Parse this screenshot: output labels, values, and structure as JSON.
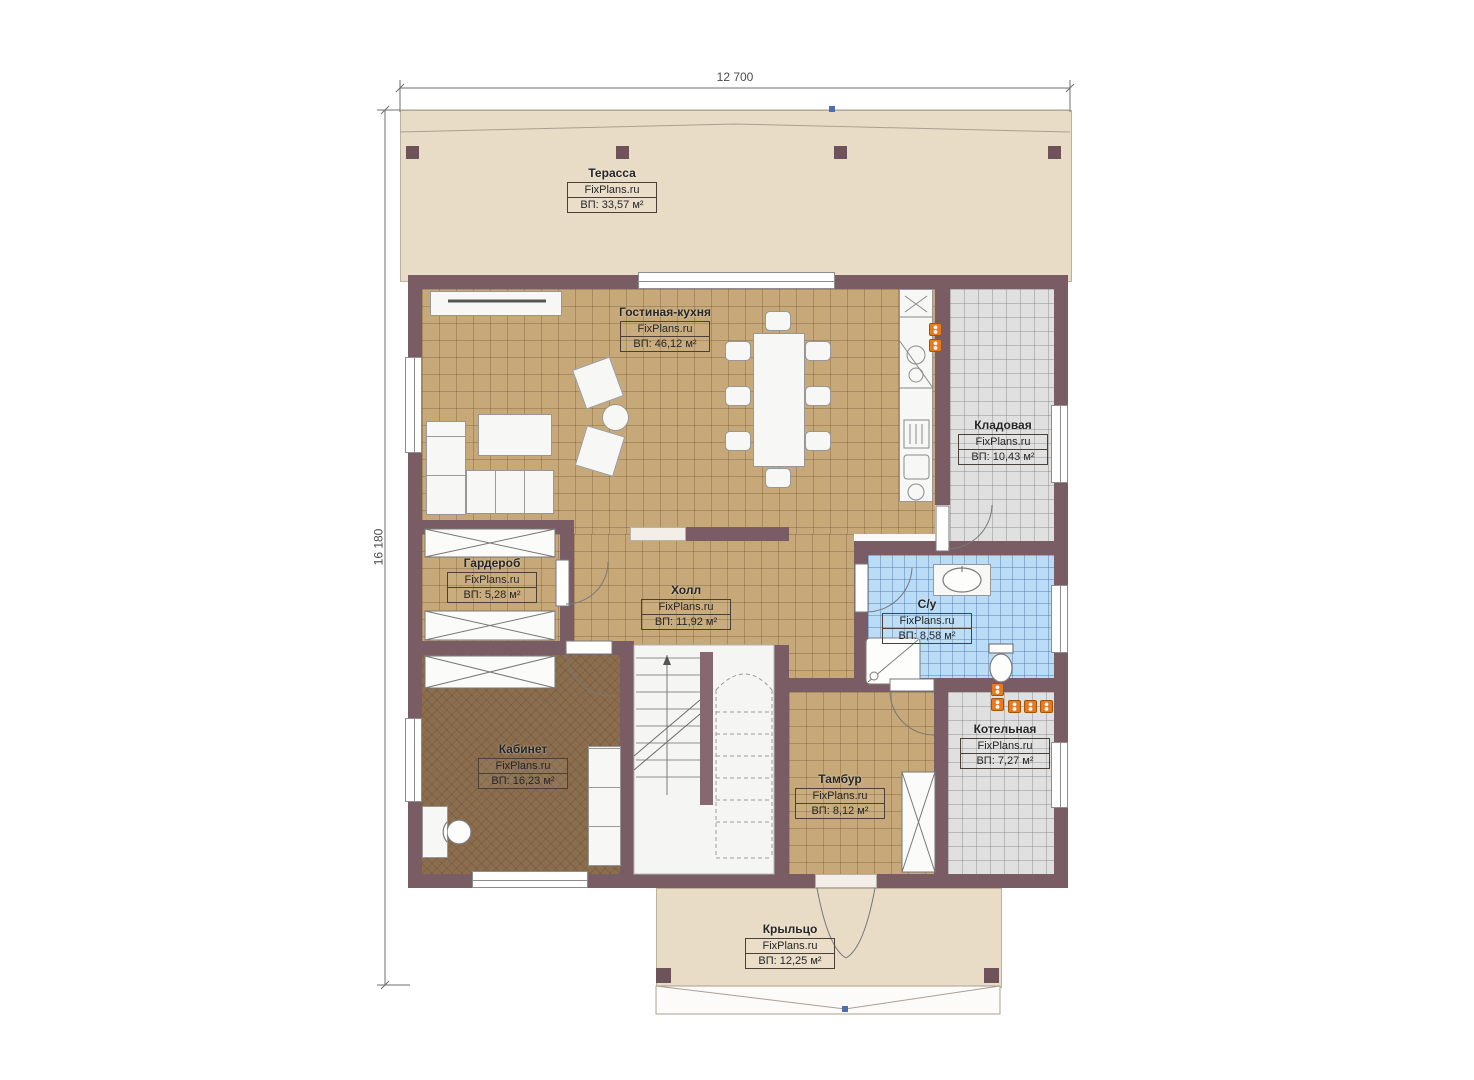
{
  "dimensions": {
    "top": "12 700",
    "left": "16 180"
  },
  "rooms": [
    {
      "key": "terrace",
      "name": "Терасса",
      "brand": "FixPlans.ru",
      "area": "ВП: 33,57 м²"
    },
    {
      "key": "living-kitchen",
      "name": "Гостиная-кухня",
      "brand": "FixPlans.ru",
      "area": "ВП: 46,12 м²"
    },
    {
      "key": "pantry",
      "name": "Кладовая",
      "brand": "FixPlans.ru",
      "area": "ВП: 10,43 м²"
    },
    {
      "key": "wardrobe",
      "name": "Гардероб",
      "brand": "FixPlans.ru",
      "area": "ВП: 5,28 м²"
    },
    {
      "key": "hall",
      "name": "Холл",
      "brand": "FixPlans.ru",
      "area": "ВП: 11,92 м²"
    },
    {
      "key": "bathroom",
      "name": "С/у",
      "brand": "FixPlans.ru",
      "area": "ВП: 8,58 м²"
    },
    {
      "key": "office",
      "name": "Кабинет",
      "brand": "FixPlans.ru",
      "area": "ВП: 16,23 м²"
    },
    {
      "key": "vestibule",
      "name": "Тамбур",
      "brand": "FixPlans.ru",
      "area": "ВП: 8,12 м²"
    },
    {
      "key": "boiler",
      "name": "Котельная",
      "brand": "FixPlans.ru",
      "area": "ВП: 7,27 м²"
    },
    {
      "key": "porch",
      "name": "Крыльцо",
      "brand": "FixPlans.ru",
      "area": "ВП: 12,25 м²"
    }
  ],
  "colors": {
    "wall": "#7a5d64",
    "floor_tan": "#c7a878",
    "floor_office": "#8c6e4e",
    "floor_blue": "#badcf6",
    "floor_gray": "#e0e0e0",
    "outdoor": "#e9dcc6",
    "radiator": "#e8791d",
    "marker_blue": "#4d6fae"
  }
}
